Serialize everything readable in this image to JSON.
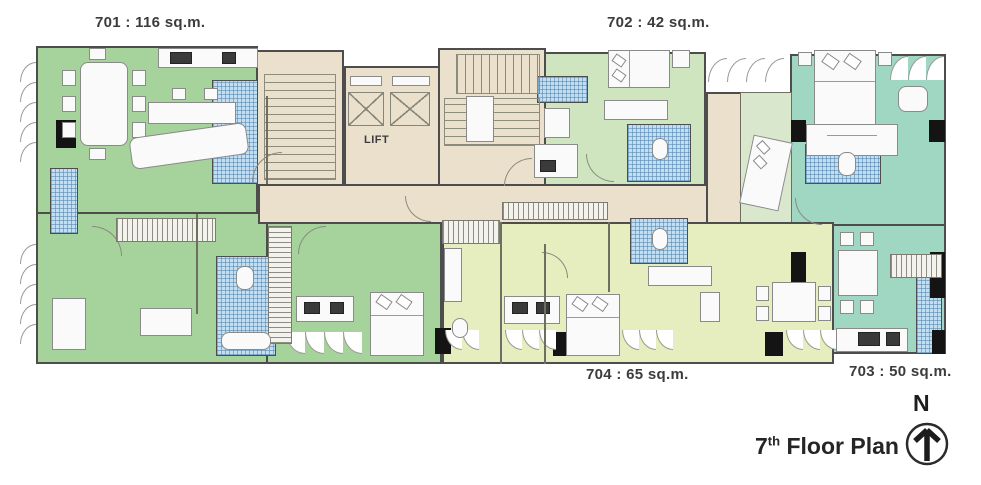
{
  "plan": {
    "unit_labels": [
      {
        "unit": "701",
        "label": "701 : 116 sq.m."
      },
      {
        "unit": "702",
        "label": "702 : 42 sq.m."
      },
      {
        "unit": "703",
        "label": "703 : 50 sq.m."
      },
      {
        "unit": "704",
        "label": "704 : 65 sq.m."
      }
    ],
    "core": {
      "lift_label": "LIFT"
    },
    "title": {
      "floor_number": "7",
      "ordinal_suffix": "th",
      "text": " Floor Plan"
    },
    "compass": {
      "label": "N"
    },
    "colors": {
      "unit_701": "#a6d29c",
      "unit_702": "#cfe5c0",
      "unit_703": "#9fd7c2",
      "unit_703_inner": "#d9e8cc",
      "unit_704": "#e6eec0",
      "core": "#eae0cc",
      "bathroom_tile": "#c2def0",
      "wall": "#4d4d4d"
    }
  }
}
